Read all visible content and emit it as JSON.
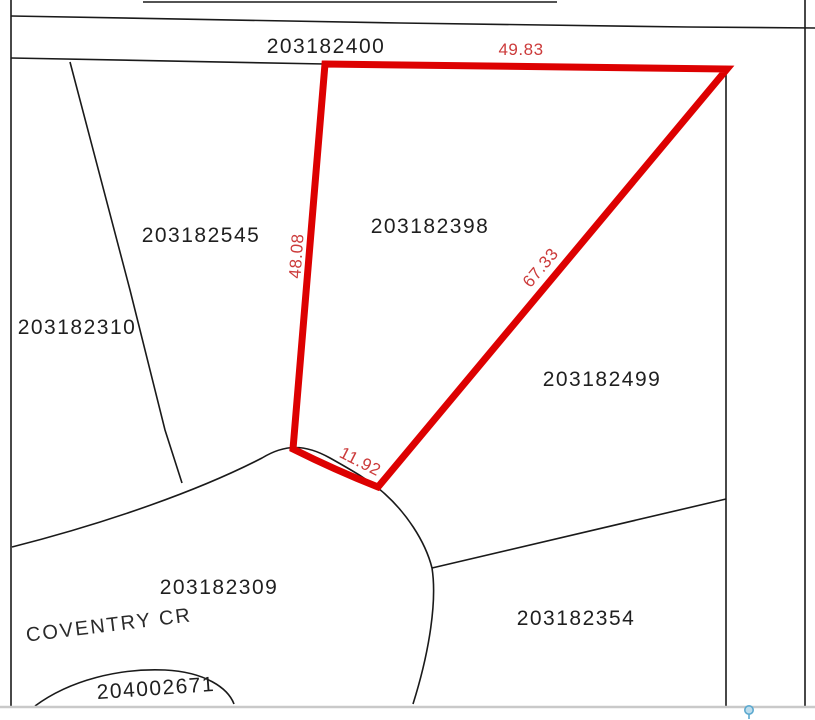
{
  "map": {
    "parcels": [
      {
        "id": "203182400"
      },
      {
        "id": "203182545"
      },
      {
        "id": "203182310"
      },
      {
        "id": "203182398"
      },
      {
        "id": "203182499"
      },
      {
        "id": "203182309"
      },
      {
        "id": "203182354"
      },
      {
        "id": "204002671"
      }
    ],
    "street_label": "COVENTRY CR",
    "highlight": {
      "parcel_id": "203182398",
      "dimensions": {
        "top": "49.83",
        "west": "48.08",
        "diagonal": "67.33",
        "arc": "11.92"
      }
    },
    "colors": {
      "highlight_outline": "#dd0101",
      "dimension_text": "#cc3b3b",
      "boundary_line": "#1a1a1a",
      "bottom_border": "#c9c9c9",
      "pin": "#5ca9cf"
    }
  }
}
